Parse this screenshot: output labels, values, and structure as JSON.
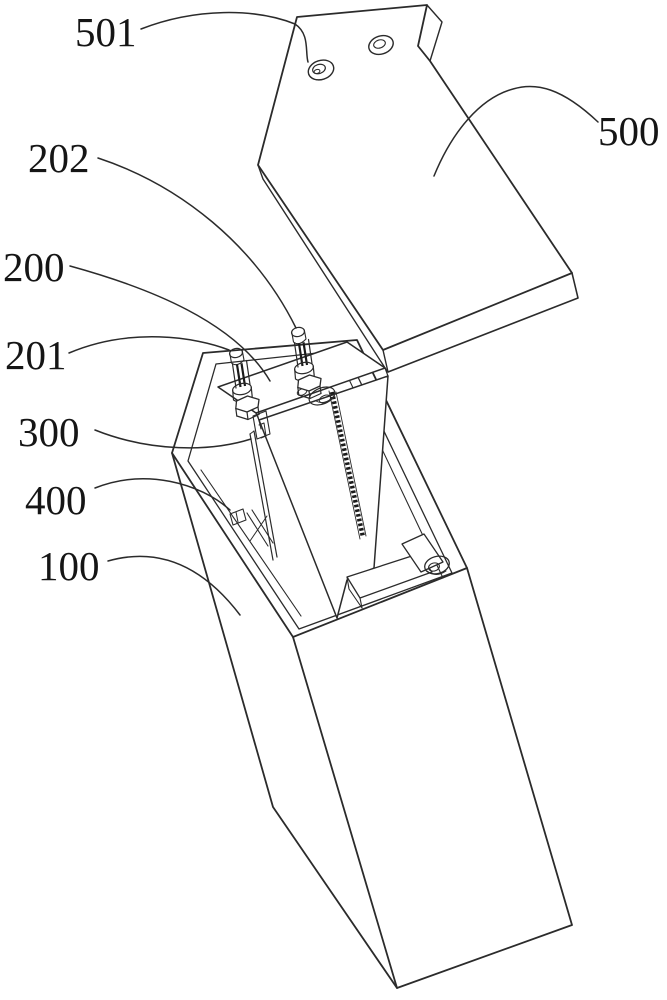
{
  "figure": {
    "description": "Exploded-view patent line drawing of a battery cell housing assembly",
    "colors": {
      "line": "#2b2b2b",
      "hatch": "#1a1a1a",
      "label": "#151515",
      "background": "#ffffff"
    },
    "labels": [
      {
        "id": "501",
        "text": "501"
      },
      {
        "id": "500",
        "text": "500"
      },
      {
        "id": "202",
        "text": "202"
      },
      {
        "id": "200",
        "text": "200"
      },
      {
        "id": "201",
        "text": "201"
      },
      {
        "id": "300",
        "text": "300"
      },
      {
        "id": "400",
        "text": "400"
      },
      {
        "id": "100",
        "text": "100"
      }
    ]
  }
}
